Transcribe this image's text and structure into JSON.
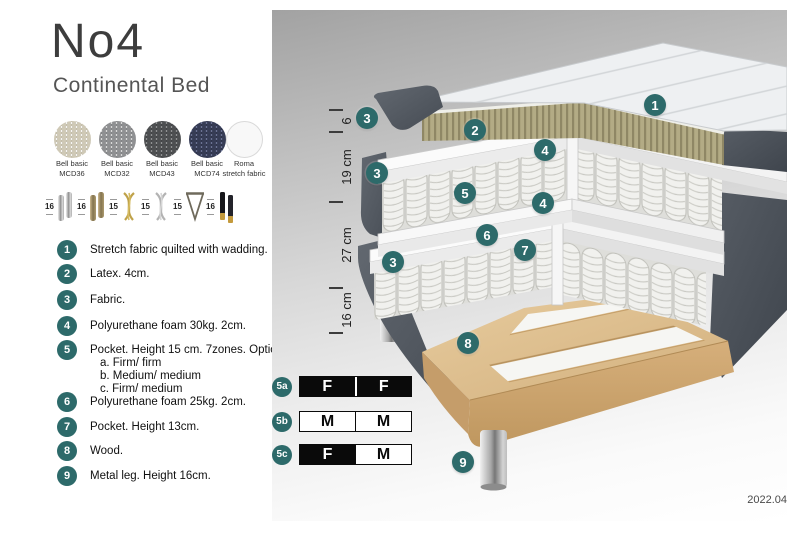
{
  "header": {
    "title": "No4",
    "subtitle": "Continental Bed"
  },
  "swatches": [
    {
      "line1": "Bell basic",
      "line2": "MCD36",
      "icon": "fabric-swatch-beige-icon"
    },
    {
      "line1": "Bell basic",
      "line2": "MCD32",
      "icon": "fabric-swatch-gray-icon"
    },
    {
      "line1": "Bell basic",
      "line2": "MCD43",
      "icon": "fabric-swatch-darkgray-icon"
    },
    {
      "line1": "Bell basic",
      "line2": "MCD74",
      "icon": "fabric-swatch-navy-icon"
    },
    {
      "line1": "Roma",
      "line2": "stretch fabric",
      "icon": "fabric-swatch-white-icon"
    }
  ],
  "legs": [
    {
      "height": "16",
      "icon": "leg-cylinder-silver-icon"
    },
    {
      "height": "16",
      "icon": "leg-cylinder-bronze-icon"
    },
    {
      "height": "15",
      "icon": "leg-twist-gold-icon"
    },
    {
      "height": "15",
      "icon": "leg-twist-silver-icon"
    },
    {
      "height": "15",
      "icon": "leg-hairpin-icon"
    },
    {
      "height": "16",
      "icon": "leg-black-brass-icon"
    }
  ],
  "list": {
    "items": [
      {
        "num": "1",
        "text": "Stretch fabric quilted with wadding."
      },
      {
        "num": "2",
        "text": "Latex. 4cm."
      },
      {
        "num": "3",
        "text": "Fabric."
      },
      {
        "num": "4",
        "text": "Polyurethane foam 30kg. 2cm."
      },
      {
        "num": "5",
        "text": "Pocket. Height 15 cm. 7zones. Option:",
        "options": [
          "a. Firm/ firm",
          "b. Medium/ medium",
          "c. Firm/ medium"
        ]
      },
      {
        "num": "6",
        "text": "Polyurethane foam 25kg. 2cm."
      },
      {
        "num": "7",
        "text": "Pocket. Height 13cm."
      },
      {
        "num": "8",
        "text": "Wood."
      },
      {
        "num": "9",
        "text": "Metal leg. Height 16cm."
      }
    ]
  },
  "panel": {
    "accent_color": "#2d6a6a",
    "dims": [
      "6",
      "19 cm",
      "27 cm",
      "16 cm"
    ],
    "callouts": [
      {
        "label": "1"
      },
      {
        "label": "2"
      },
      {
        "label": "3"
      },
      {
        "label": "4"
      },
      {
        "label": "3"
      },
      {
        "label": "5"
      },
      {
        "label": "4"
      },
      {
        "label": "6"
      },
      {
        "label": "7"
      },
      {
        "label": "3"
      },
      {
        "label": "8"
      },
      {
        "label": "9"
      }
    ],
    "firmness": [
      {
        "id": "5a",
        "left": "F",
        "right": "F"
      },
      {
        "id": "5b",
        "left": "M",
        "right": "M"
      },
      {
        "id": "5c",
        "left": "F",
        "right": "M"
      }
    ],
    "version": "2022.04"
  }
}
